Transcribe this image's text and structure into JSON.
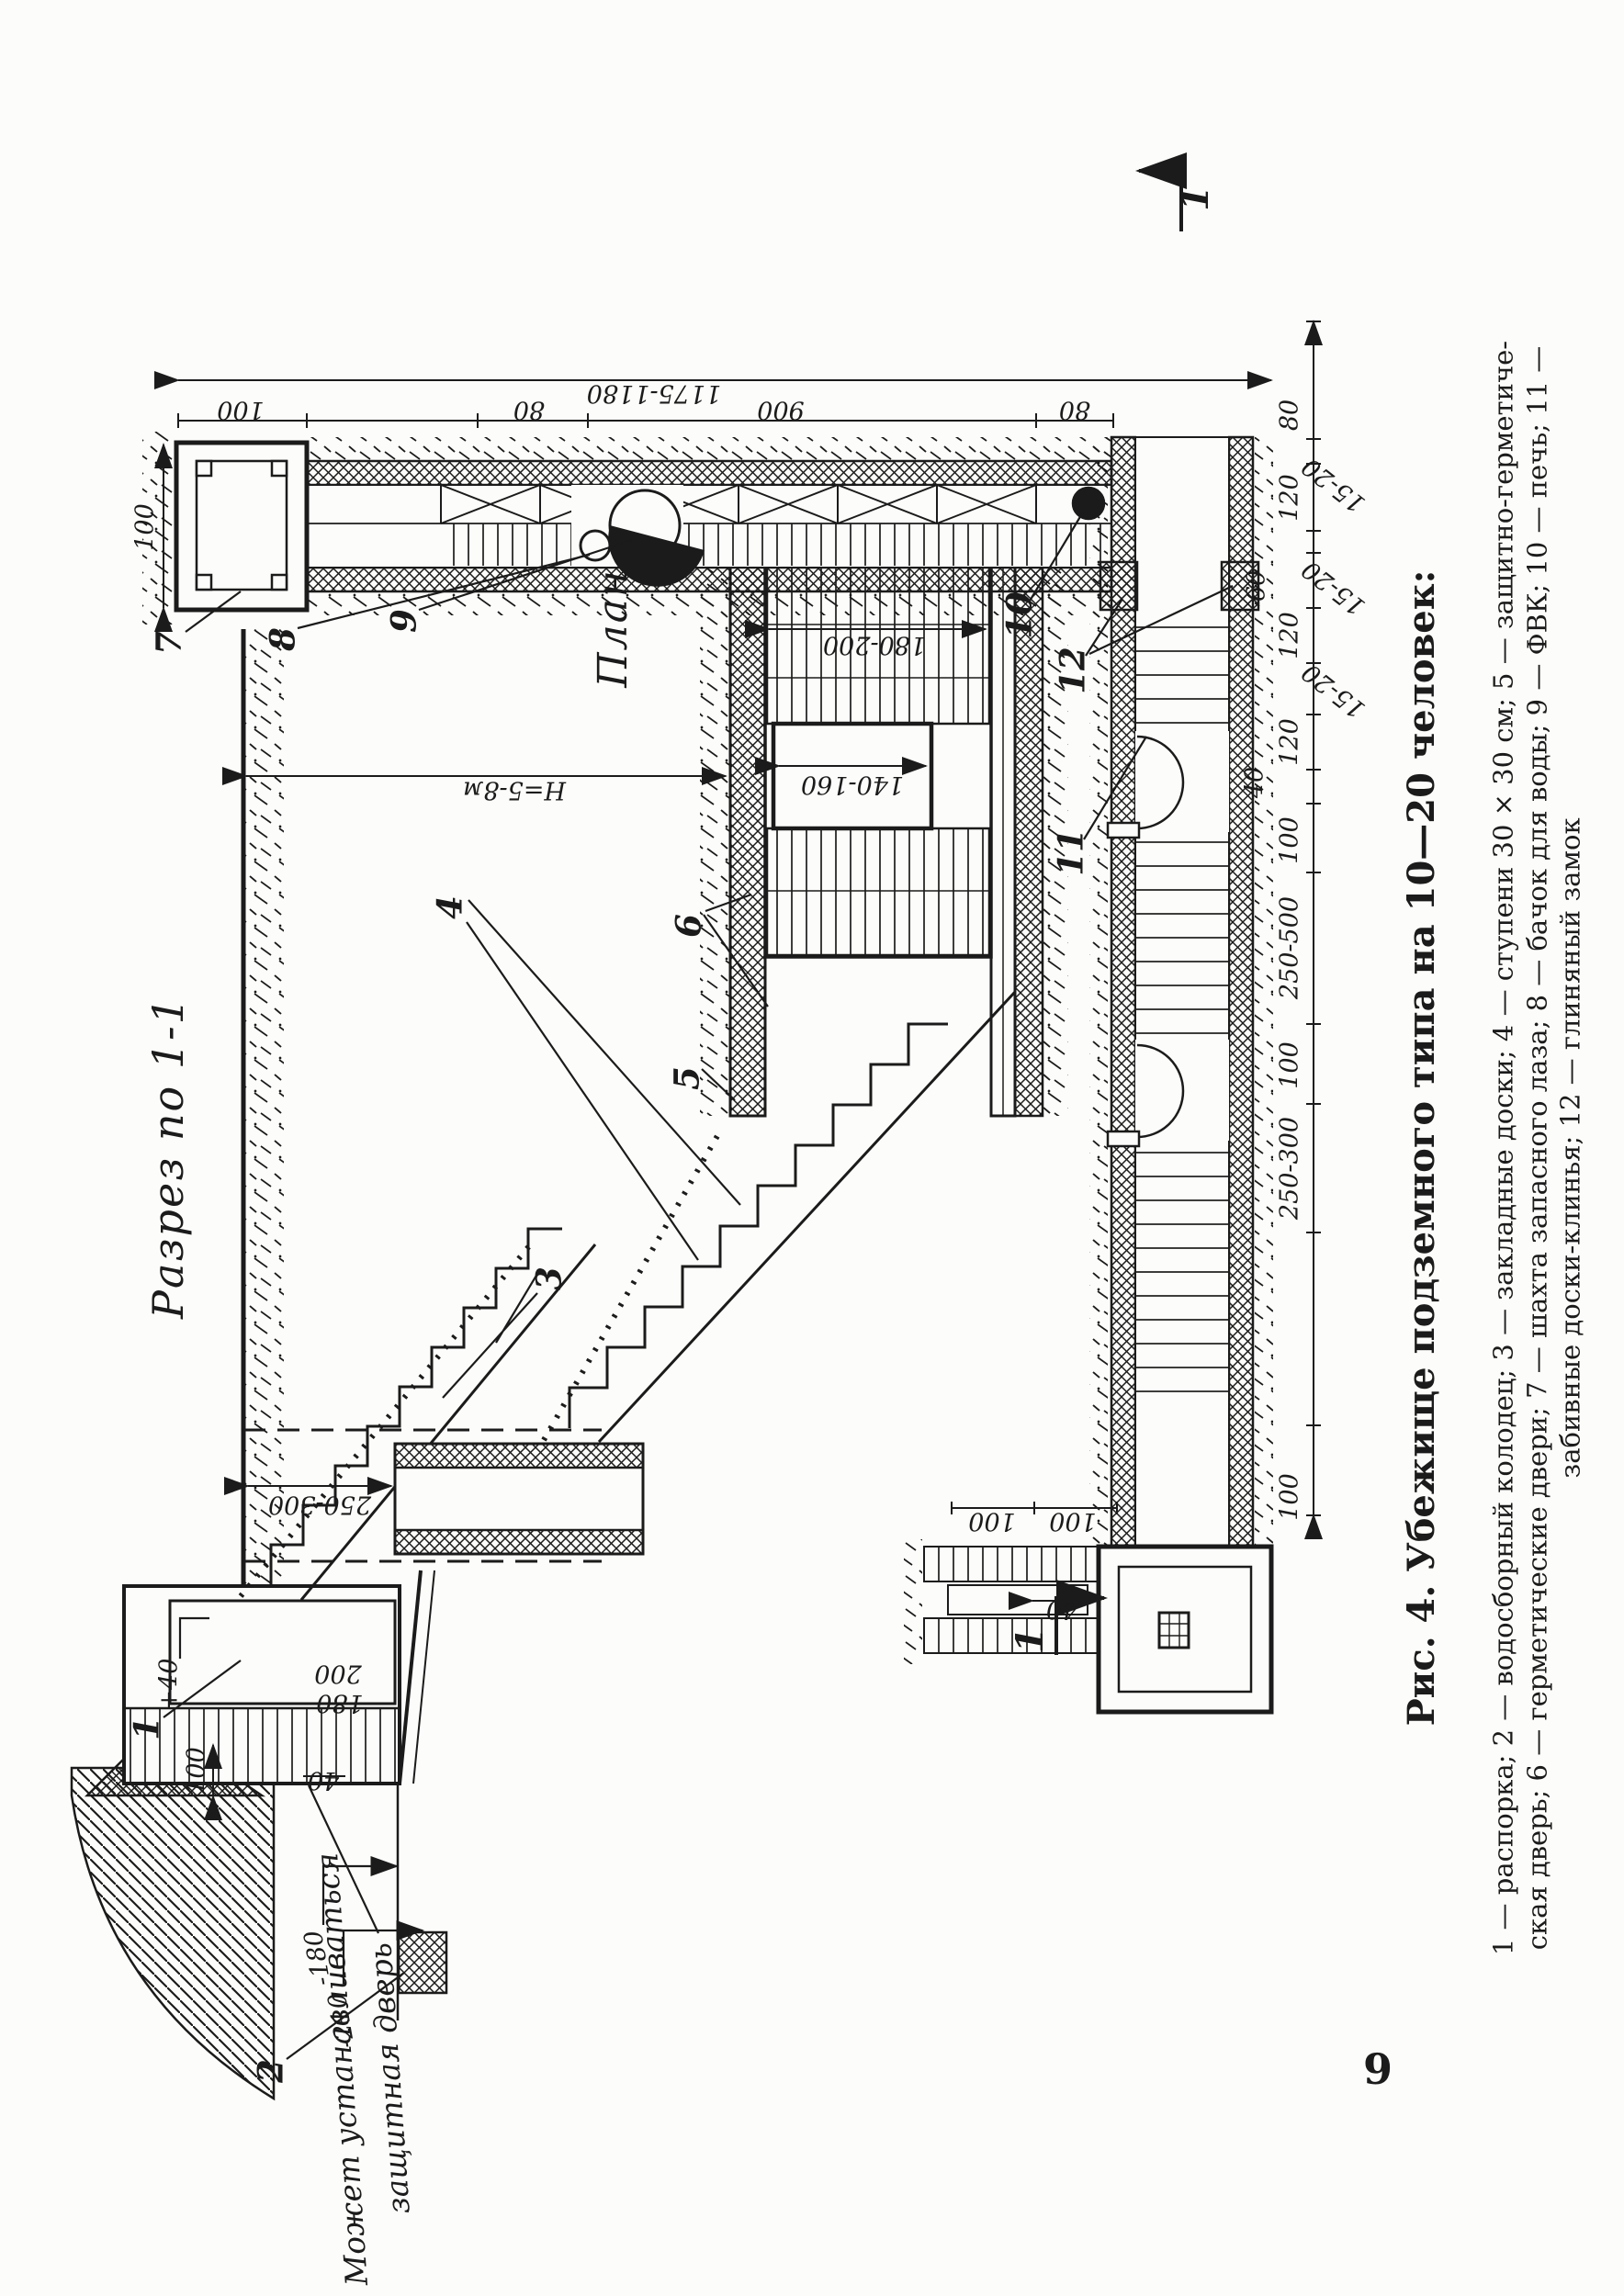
{
  "page": {
    "number": "9"
  },
  "figure": {
    "section_title": "Разрез по 1-1",
    "plan_title": "План",
    "section_mark": "1",
    "note_line1": "Может устанавливаться",
    "note_line2": "защитная дверь"
  },
  "labels": {
    "n1": "1",
    "n2": "2",
    "n3": "3",
    "n4": "4",
    "n5": "5",
    "n6": "6",
    "n7": "7",
    "n8": "8",
    "n9": "9",
    "n10": "10",
    "n11": "11",
    "n12": "12"
  },
  "dims": {
    "d40": "40",
    "d60": "60",
    "d80": "80",
    "d100": "100",
    "d120": "120",
    "d180": "180",
    "d200": "200",
    "d900": "900",
    "d15_20": "15-20",
    "d140_160": "140-160",
    "d180_200": "180-200",
    "d250_300": "250-300",
    "d250_500": "250-500",
    "d1175_1180": "1175-1180",
    "dp40": "+40",
    "dm180": "-180",
    "dm210": "-210",
    "dH": "Н=5-8м"
  },
  "caption": {
    "title": "Рис. 4. Убежище подземного типа на 10—20 человек:",
    "line2": "1 — распорка; 2 — водосборный колодец; 3 — закладные доски; 4 — ступени 30 × 30 см; 5 — защитно-герметиче-",
    "line3": "ская дверь; 6 — герметические двери; 7 — шахта запасного лаза; 8 — бачок для воды; 9 — ФВК; 10 — печь; 11 —",
    "line4": "забивные доски-клинья; 12 — глиняный замок"
  }
}
